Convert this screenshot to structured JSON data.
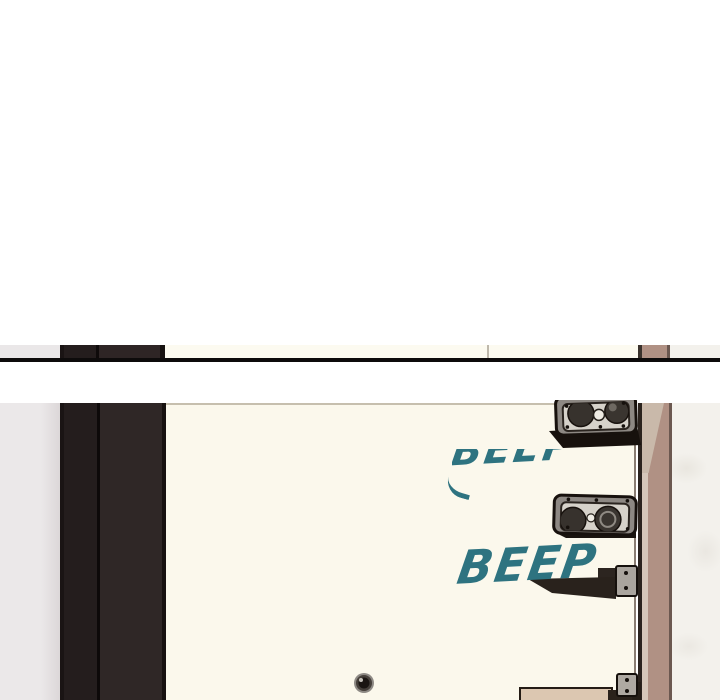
{
  "scene": {
    "type": "webtoon-panel-strip",
    "description": "Blank page top, sliver of previous panel above a black border, then a panel showing the inside of an apartment door with two electronic lock devices, a handle, a peephole and beep sound effects",
    "sfx": {
      "beep1": {
        "text": "BEEP",
        "style": "top-faded",
        "color": "#2e7380"
      },
      "beep2": {
        "text": "BEEP",
        "style": "full",
        "color": "#2e7380"
      }
    },
    "objects": [
      "previous-panel-sliver",
      "panel-border-line",
      "left-wall",
      "dark-door-frame",
      "apartment-door",
      "electronic-lock-upper",
      "electronic-lock-lower",
      "door-handle-bar",
      "bottom-hinge-bar",
      "peephole",
      "door-jamb-strip",
      "right-wall"
    ],
    "colors": {
      "page_background": "#ffffff",
      "door_cream": "#fbf8ec",
      "frame_dark_a": "#241d1d",
      "frame_dark_b": "#2f2726",
      "jamb_mauve": "#b09184",
      "jamb_highlight": "#d5c6b9",
      "wall_left": "#ebe8e9",
      "wall_right": "#f3f1ec",
      "panel_border": "#0d0b0b",
      "sfx_teal": "#2e7380",
      "hardware_gray": "#8d8883",
      "hardware_panel": "#d6d2ca",
      "hardware_outline": "#17110d",
      "bottom_bar_tan": "#dcc7b1"
    }
  }
}
